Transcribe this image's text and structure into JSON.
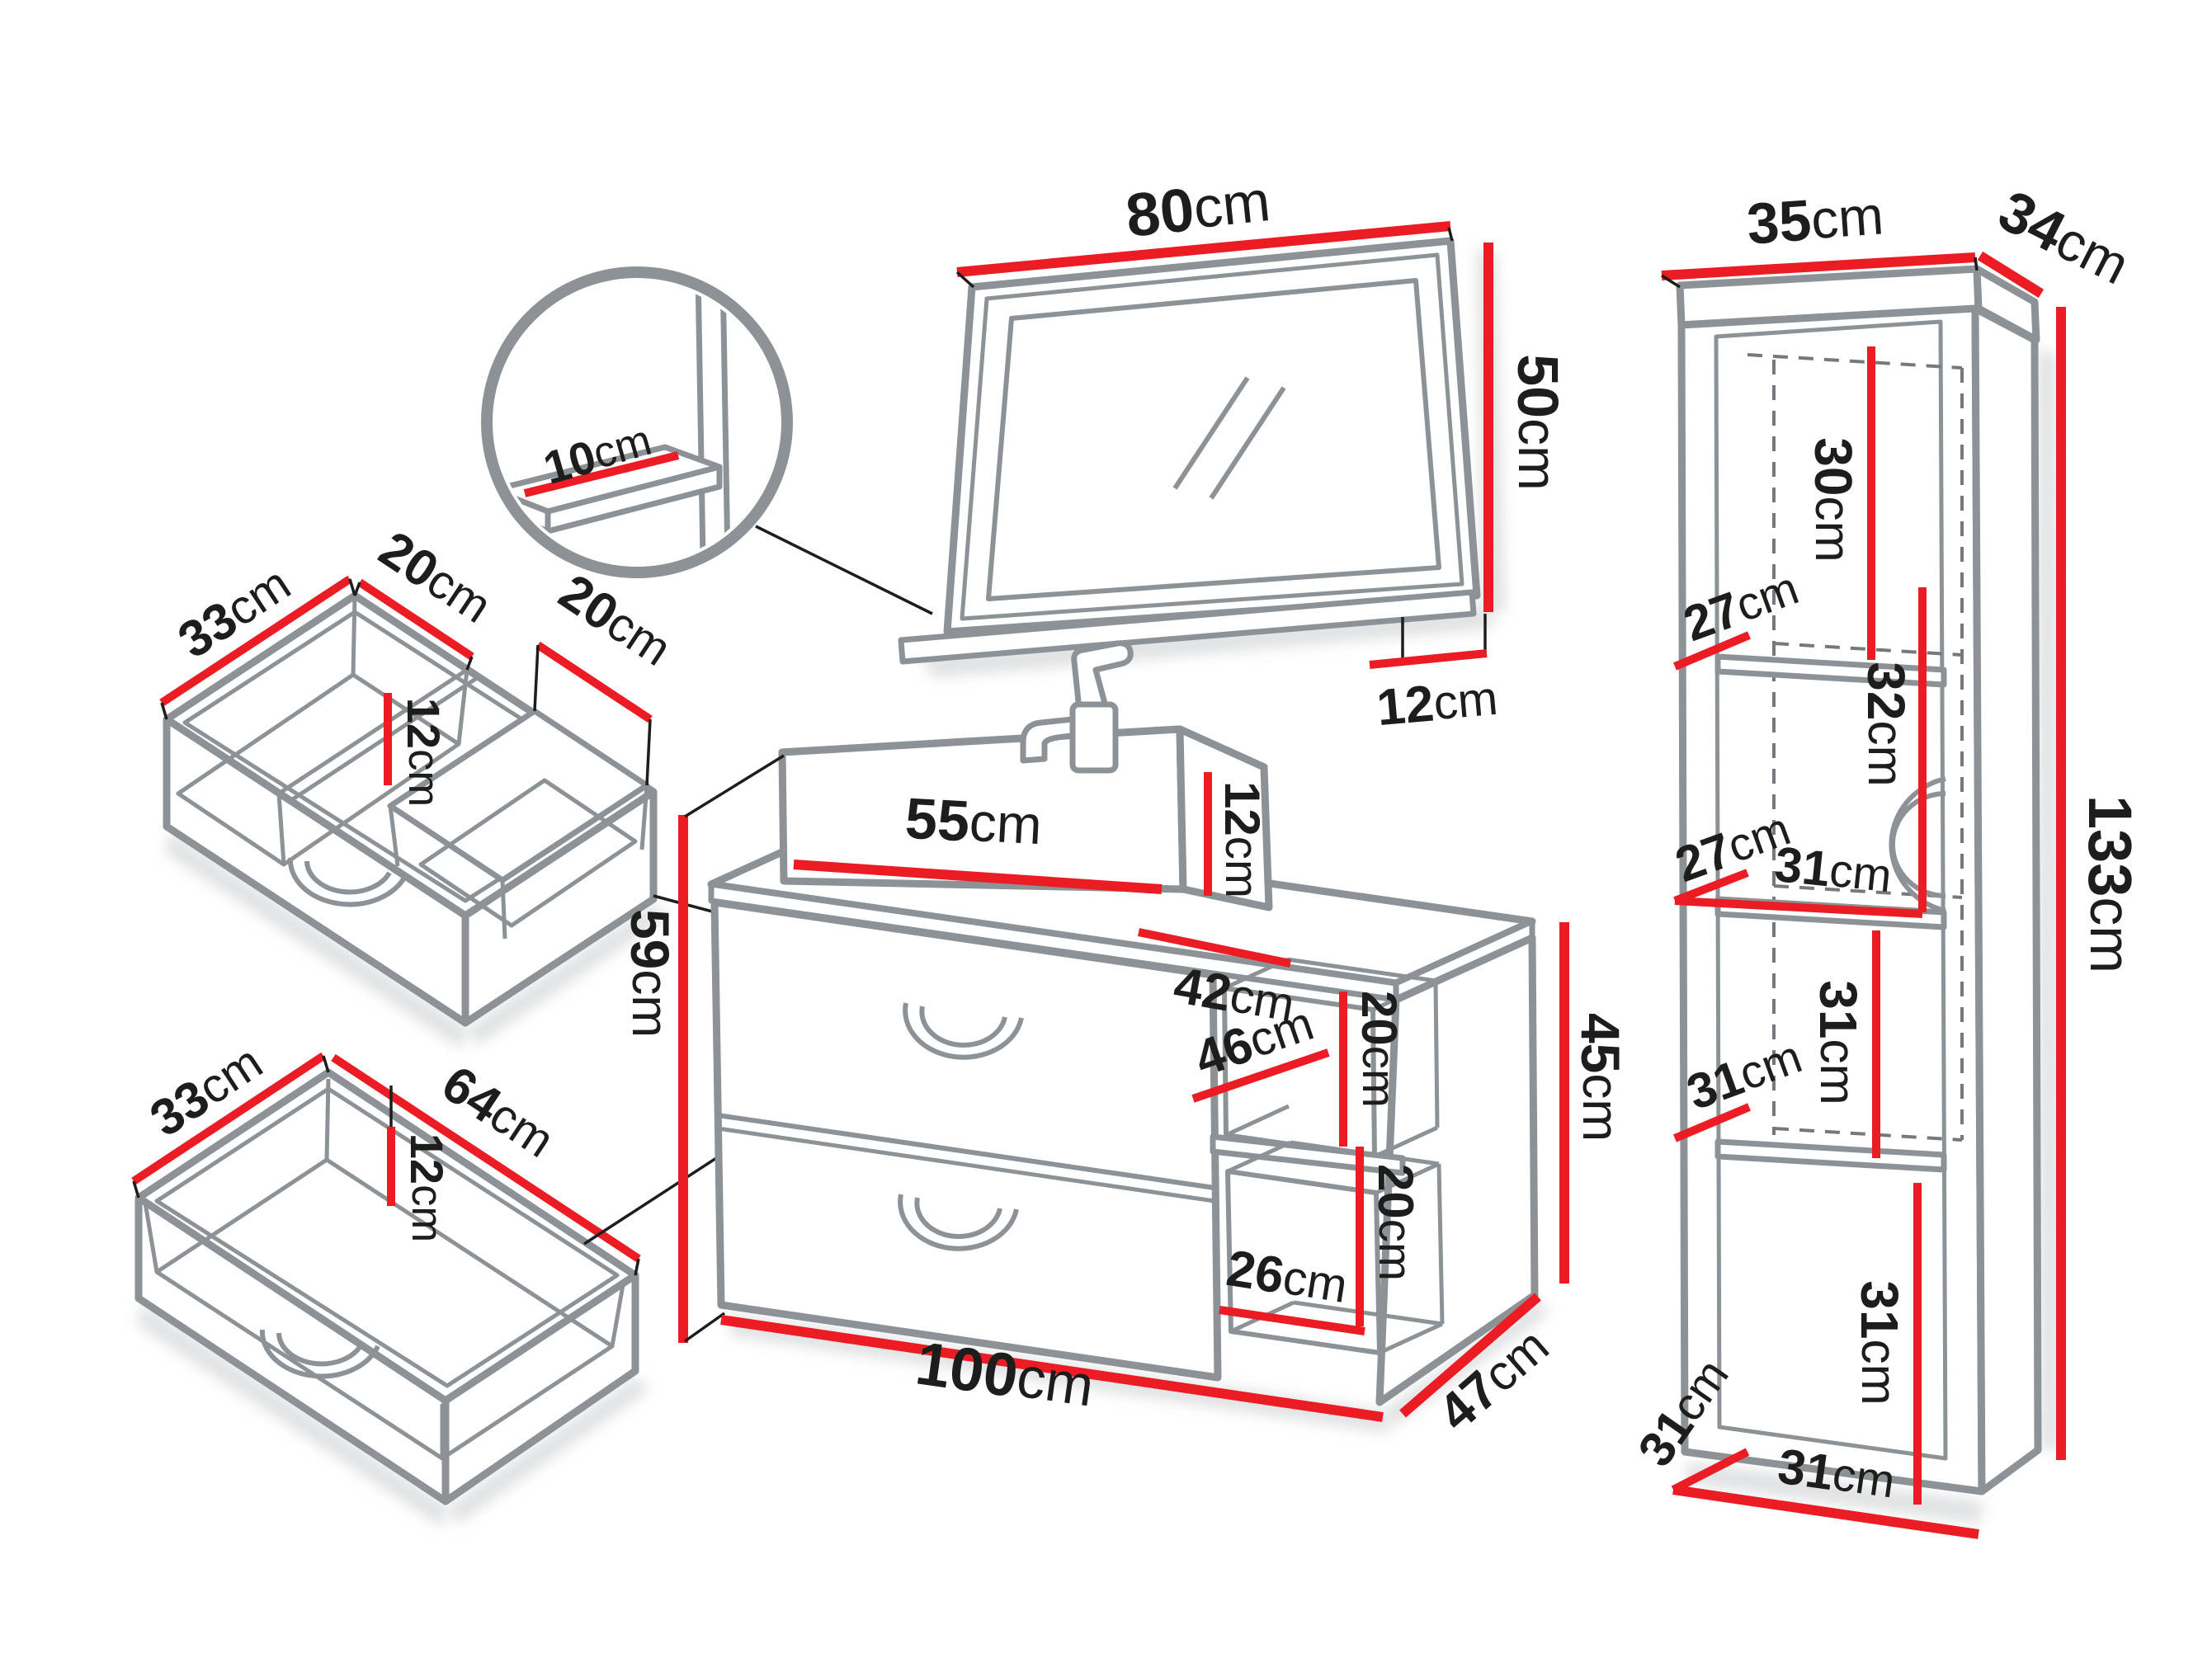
{
  "unit": "cm",
  "colors": {
    "dimension_red": "#ec1c24",
    "outline_gray": "#8d9296"
  },
  "pieces": {
    "mirror_detail": {
      "shelf_overhang": "10"
    },
    "mirror": {
      "width": "80",
      "height": "50",
      "shelf_depth": "12"
    },
    "sink_drawer": {
      "depth": "33",
      "left_width": "20",
      "inner_height": "12",
      "right_width": "20"
    },
    "wide_drawer": {
      "depth": "33",
      "width": "64",
      "inner_height": "12"
    },
    "vanity": {
      "sink_width": "55",
      "sink_height": "12",
      "top_depth": "42",
      "front_height": "59",
      "niche_depth": "46",
      "upper_niche_height": "20",
      "side_height": "45",
      "lower_niche_height": "20",
      "niche_width": "26",
      "width": "100",
      "depth": "47"
    },
    "tall_cabinet": {
      "width": "35",
      "depth": "34",
      "section1_height": "30",
      "shelf1_depth": "27",
      "section2_height": "32",
      "shelf2_depth": "27",
      "shelf2_width": "31",
      "section3_height": "31",
      "shelf3_depth": "31",
      "section4_height": "31",
      "shelf4_depth": "31",
      "shelf4_width": "31",
      "height": "133"
    }
  }
}
